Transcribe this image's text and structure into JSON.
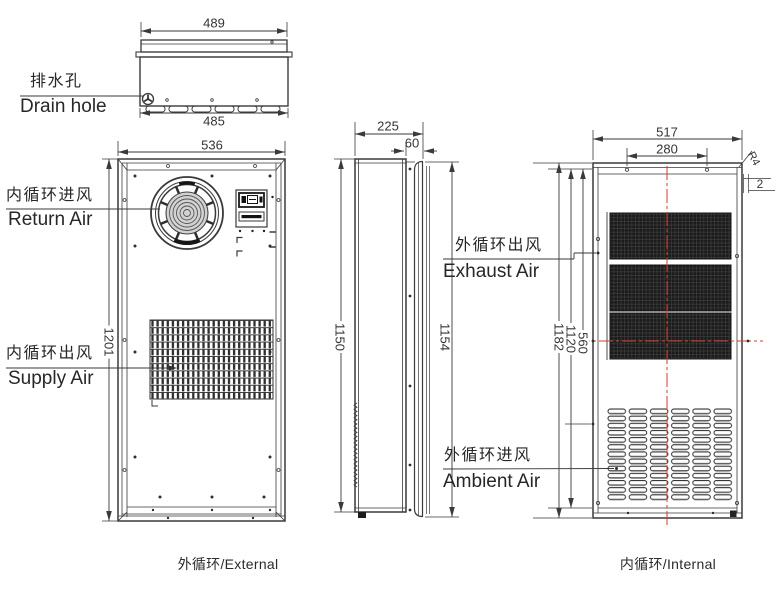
{
  "drawing": {
    "top_view": {
      "dim_top_width": "489",
      "dim_bottom_width": "485",
      "drain_cn": "排水孔",
      "drain_en": "Drain hole"
    },
    "external_view": {
      "dim_width": "536",
      "dim_height": "1201",
      "return_cn": "内循环进风",
      "return_en": "Return Air",
      "supply_cn": "内循环出风",
      "supply_en": "Supply Air",
      "caption": "外循环/External"
    },
    "side_view": {
      "dim_depth": "225",
      "dim_flange": "60",
      "dim_body_height": "1150",
      "dim_total_height": "1154"
    },
    "internal_view": {
      "dim_width": "517",
      "dim_hole_span": "280",
      "corner_radius": "R4",
      "dim_offset": "2",
      "dim_height": "1182",
      "dim_hole_height": "1120",
      "dim_center_height": "560",
      "exhaust_cn": "外循环出风",
      "exhaust_en": "Exhaust Air",
      "ambient_cn": "外循环进风",
      "ambient_en": "Ambient Air",
      "caption": "内循环/Internal"
    },
    "colors": {
      "line": "#3a3a3a",
      "centerline_red": "#d43c2e"
    }
  }
}
